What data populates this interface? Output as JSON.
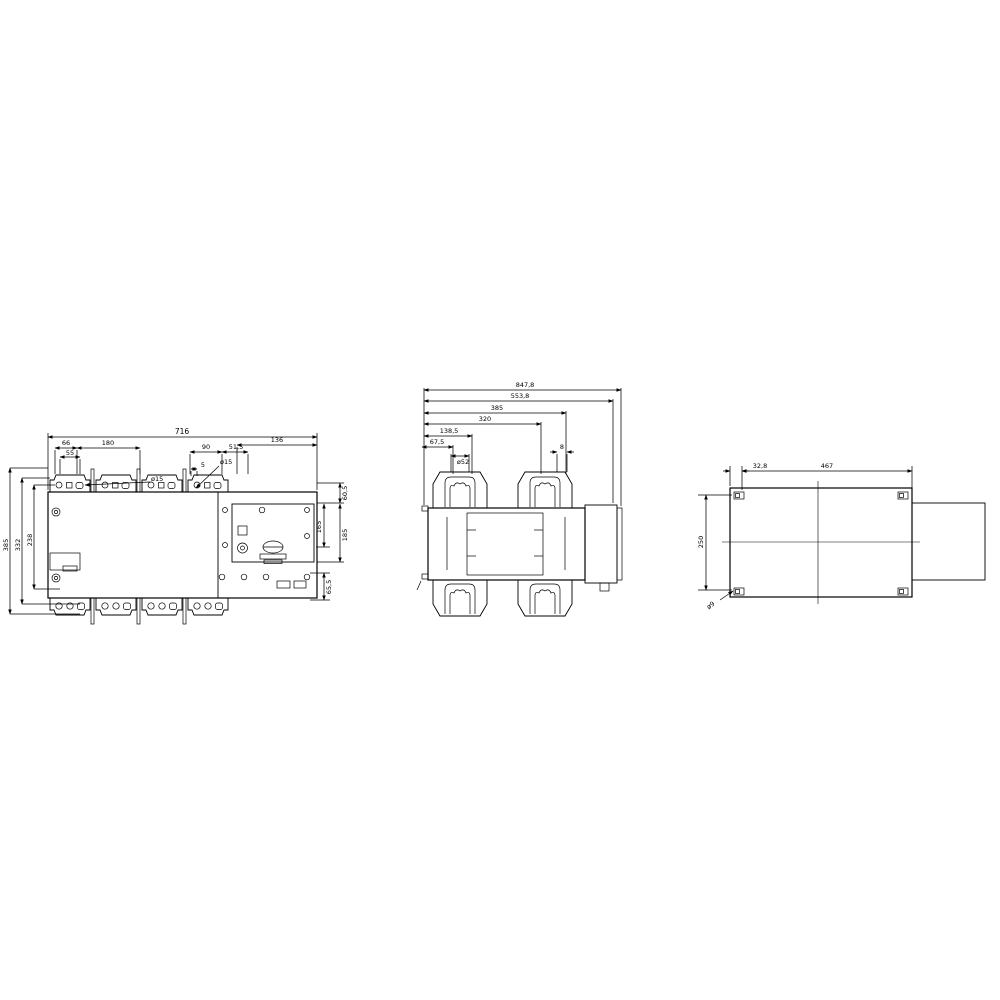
{
  "drawing": {
    "type": "engineering-dimension-drawing",
    "background": "#ffffff",
    "line_color": "#000000",
    "front": {
      "dims": {
        "overall_width": "716",
        "left_a": "66",
        "left_b": "180",
        "left_c": "55",
        "hole_left": "ø15",
        "right_a": "90",
        "right_b": "51,5",
        "right_c": "5",
        "hole_right": "ø15",
        "right_d": "136",
        "vert_outer": "385",
        "vert_mid": "332",
        "vert_inner": "238",
        "rv_top": "60,5",
        "rv_inner": "165",
        "rv_outer": "185",
        "rv_bottom": "65,5"
      }
    },
    "top": {
      "dims": {
        "w1": "847,8",
        "w2": "553,8",
        "w3": "385",
        "w4": "320",
        "w5": "138,5",
        "w6": "67,5",
        "clamp": "ø52",
        "slot": "8"
      }
    },
    "side": {
      "dims": {
        "offset": "32,8",
        "depth": "467",
        "height": "250",
        "hole": "ø9"
      }
    }
  }
}
